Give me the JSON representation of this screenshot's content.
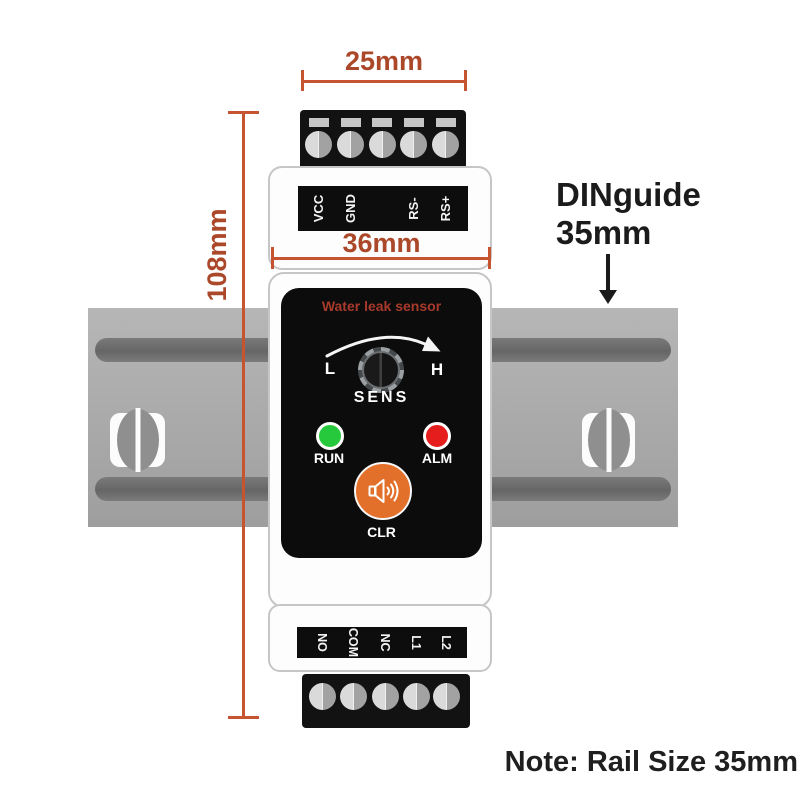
{
  "annotations": {
    "dim_top_width": "25mm",
    "dim_body_width": "36mm",
    "dim_height": "108mm",
    "din_guide_line1": "DINguide",
    "din_guide_line2": "35mm",
    "note": "Note: Rail Size 35mm"
  },
  "device": {
    "panel_title": "Water leak sensor",
    "knob_label": "SENS",
    "knob_low": "L",
    "knob_high": "H",
    "led_run_label": "RUN",
    "led_alm_label": "ALM",
    "button_label": "CLR",
    "top_terminal_labels": [
      "VCC",
      "GND",
      "RS-",
      "RS+"
    ],
    "bottom_terminal_labels": [
      "NO",
      "COM",
      "NC",
      "L1",
      "L2"
    ]
  },
  "colors": {
    "dimension_text": "#ab482a",
    "dimension_line": "#c75430",
    "panel_title": "#a83a2c",
    "led_run": "#26c93c",
    "led_alm": "#e61d1d",
    "clr_button": "#e2702a",
    "rail_gray": "#ababab"
  }
}
